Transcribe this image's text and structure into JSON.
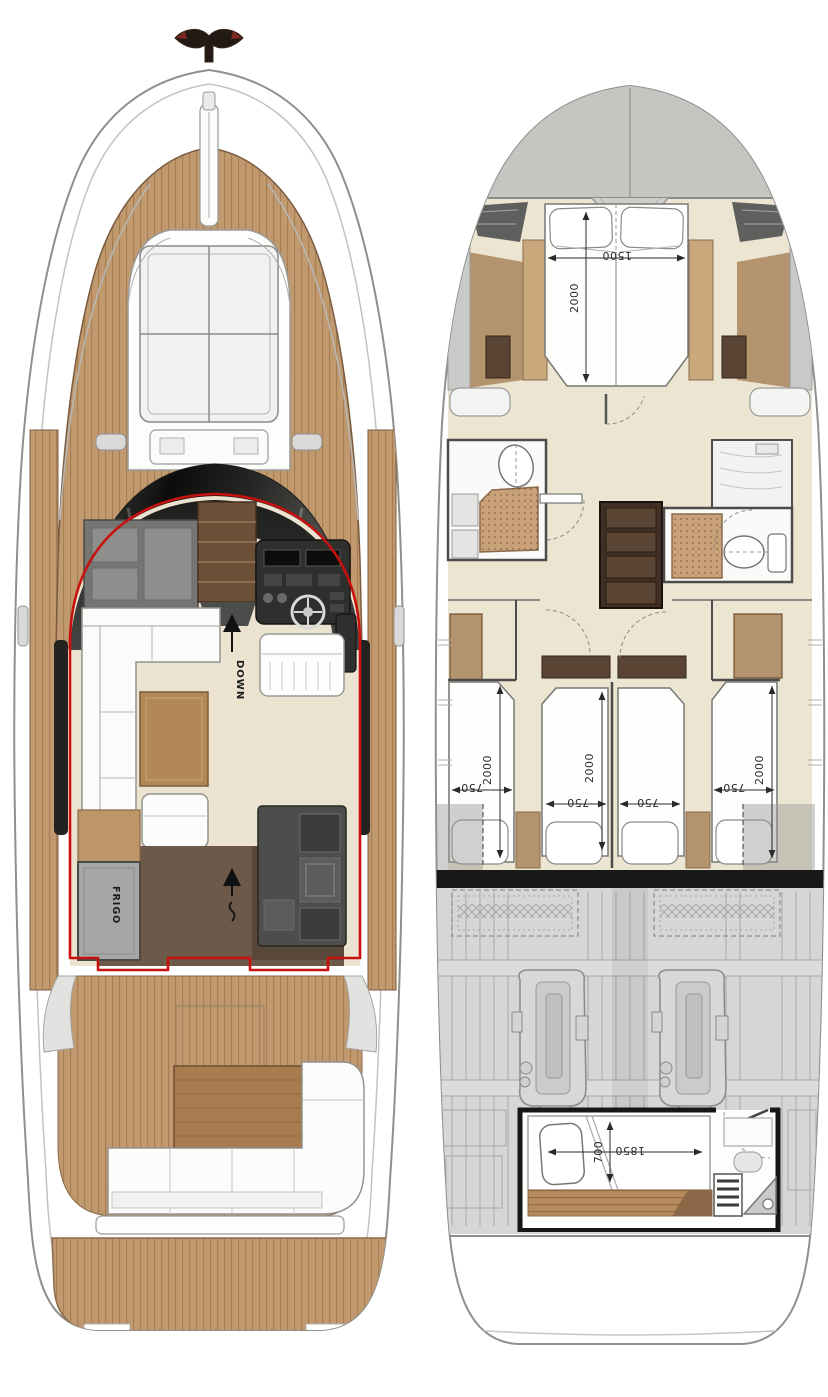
{
  "figure": {
    "type": "yacht-deck-plans",
    "views": [
      "main-deck",
      "lower-deck"
    ]
  },
  "plans": {
    "main_deck": {
      "labels": {
        "down": "DOWN",
        "frigo": "FRIGO"
      }
    },
    "lower_deck": {
      "master_cabin": {
        "bed_length": "2000",
        "bed_width": "1500"
      },
      "guest_cabins": {
        "bed1_length": "2000",
        "bed1_width": "750",
        "bed2_length": "2000",
        "bed2_width": "750",
        "bed3_width": "750",
        "bed4_length": "2000",
        "bed4_width": "750"
      },
      "crew_cabin": {
        "bed_length": "1850",
        "bed_width": "700"
      }
    }
  },
  "colors": {
    "teak": "#c09a6e",
    "teak_stripe": "#a47c50",
    "wood_trim": "#8a6a4c",
    "cream_floor": "#ece5d2",
    "salon_outline_red": "#c8100e",
    "dark_wood": "#5a4434",
    "hull_gray": "#c6c5c2",
    "engine_room_gray": "#d6d6d4",
    "windshield_black": "#111110"
  }
}
